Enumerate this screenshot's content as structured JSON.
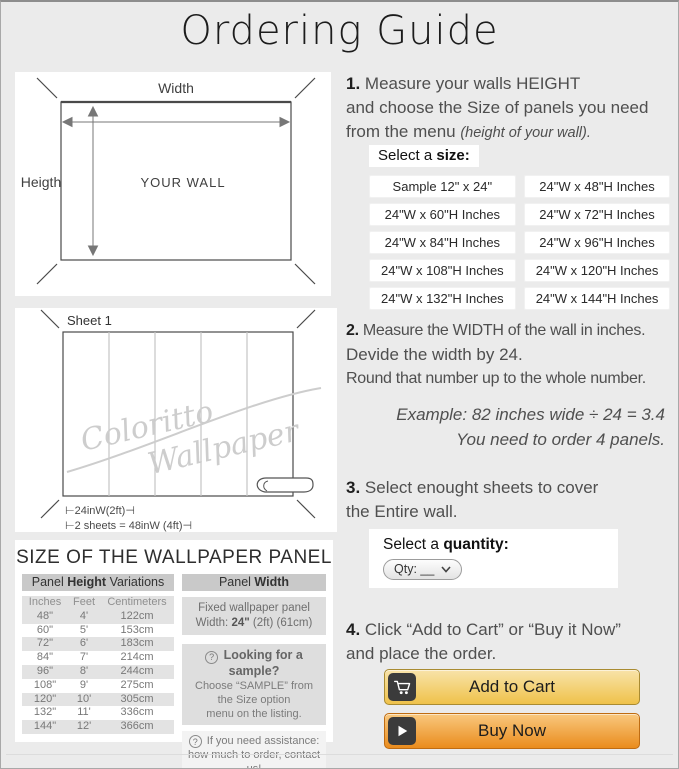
{
  "title": "Ordering Guide",
  "colors": {
    "page_bg": "#ebebeb",
    "add_cart_top": "#f8e3a9",
    "add_cart_bottom": "#efc24a",
    "add_cart_border": "#a98b32",
    "buy_top": "#f9c87e",
    "buy_bottom": "#ea8c1d",
    "buy_border": "#bf6c12",
    "icon_square": "#3b3b3b"
  },
  "wall_diagram": {
    "width_label": "Width",
    "height_label": "Heigth",
    "center_label": "YOUR WALL"
  },
  "sheet_diagram": {
    "sheet_label": "Sheet 1",
    "watermark_1": "Coloritto",
    "watermark_2": "Wallpaper",
    "dim_1": "⊢24inW(2ft)⊣",
    "dim_2": "⊢2 sheets = 48inW (4ft)⊣"
  },
  "step1": {
    "num": "1.",
    "line1": " Measure your walls HEIGHT",
    "line2": "and choose the Size of panels you need",
    "line3": "from the menu ",
    "line3_note": "(height of your wall)."
  },
  "size_selector": {
    "label": "Select a ",
    "label_bold": "size:",
    "options": [
      "Sample 12\" x 24\"",
      "24\"W x 48\"H Inches",
      "24\"W x 60\"H Inches",
      "24\"W x 72\"H Inches",
      "24\"W x 84\"H Inches",
      "24\"W x 96\"H Inches",
      "24\"W x 108\"H Inches",
      "24\"W x 120\"H Inches",
      "24\"W x 132\"H Inches",
      "24\"W x 144\"H Inches"
    ]
  },
  "step2": {
    "num": "2.",
    "line1": " Measure the WIDTH of the wall in inches.",
    "line2": "Devide the width by 24.",
    "line3": "Round that number up to the whole number.",
    "example1": "Example: 82 inches wide ÷ 24 = 3.4",
    "example2": "You need to order 4 panels."
  },
  "step3": {
    "num": "3.",
    "line1": " Select enought sheets to cover",
    "line2": "the Entire wall."
  },
  "quantity": {
    "label": "Select a ",
    "label_bold": "quantity:",
    "dropdown_value": "Qty: __"
  },
  "step4": {
    "num": "4.",
    "line1": " Click “Add to Cart” or “Buy it Now”",
    "line2": "and place the order."
  },
  "actions": {
    "add_to_cart": "Add to Cart",
    "buy_now": "Buy Now"
  },
  "panel_info": {
    "title": "SIZE OF THE WALLPAPER PANEL",
    "height_header": {
      "pre": "Panel ",
      "bold": "Height",
      "post": " Variations"
    },
    "width_header": {
      "pre": "Panel ",
      "bold": "Width"
    },
    "table": {
      "columns": [
        "Inches",
        "Feet",
        "Centimeters"
      ],
      "rows": [
        [
          "48\"",
          "4'",
          "122cm"
        ],
        [
          "60\"",
          "5'",
          "153cm"
        ],
        [
          "72\"",
          "6'",
          "183cm"
        ],
        [
          "84\"",
          "7'",
          "214cm"
        ],
        [
          "96\"",
          "8'",
          "244cm"
        ],
        [
          "108\"",
          "9'",
          "275cm"
        ],
        [
          "120\"",
          "10'",
          "305cm"
        ],
        [
          "132\"",
          "11'",
          "336cm"
        ],
        [
          "144\"",
          "12'",
          "366cm"
        ]
      ]
    },
    "width_info": {
      "line1": "Fixed wallpaper panel",
      "line2_pre": "Width: ",
      "line2_bold": "24\"",
      "line2_post": " (2ft) (61cm)"
    },
    "sample_note": {
      "icon": "?",
      "title": " Looking for a sample?",
      "line1": "Choose “SAMPLE” from",
      "line2": "the Size option",
      "line3": "menu on the listing."
    },
    "assist_note": {
      "icon": "?",
      "line1": " If you need assistance:",
      "line2": "how much to order, contact us!"
    }
  }
}
